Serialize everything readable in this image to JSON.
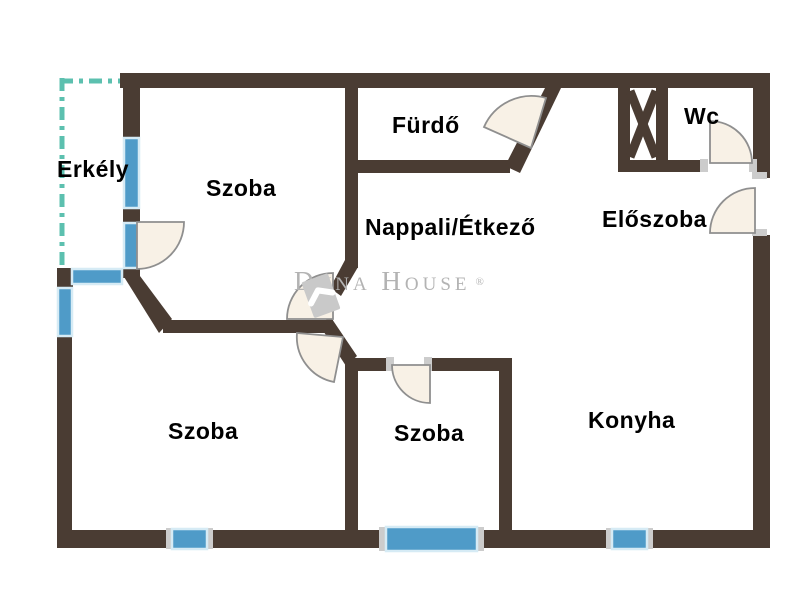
{
  "labels": {
    "erkely": "Erkély",
    "szoba_top": "Szoba",
    "furdo": "Fürdő",
    "wc": "Wc",
    "nappali": "Nappali/Étkező",
    "eloszoba": "Előszoba",
    "szoba_bottom_left": "Szoba",
    "szoba_bottom_middle": "Szoba",
    "konyha": "Konyha"
  },
  "watermark": {
    "brand": "Duna House",
    "registered_mark": "®"
  },
  "colors": {
    "wall": "#4a3c33",
    "window_fill": "#4f9bc8",
    "window_edge": "#d6ebf5",
    "balcony_dash": "#5cc0af",
    "door_fill": "#f8f1e6",
    "door_edge": "#8f8f8f",
    "watermark": "#b3b3b3",
    "watermark_light": "#c9c9c9",
    "label_text": "#000000",
    "background": "#ffffff",
    "jamb": "#cccccc"
  }
}
